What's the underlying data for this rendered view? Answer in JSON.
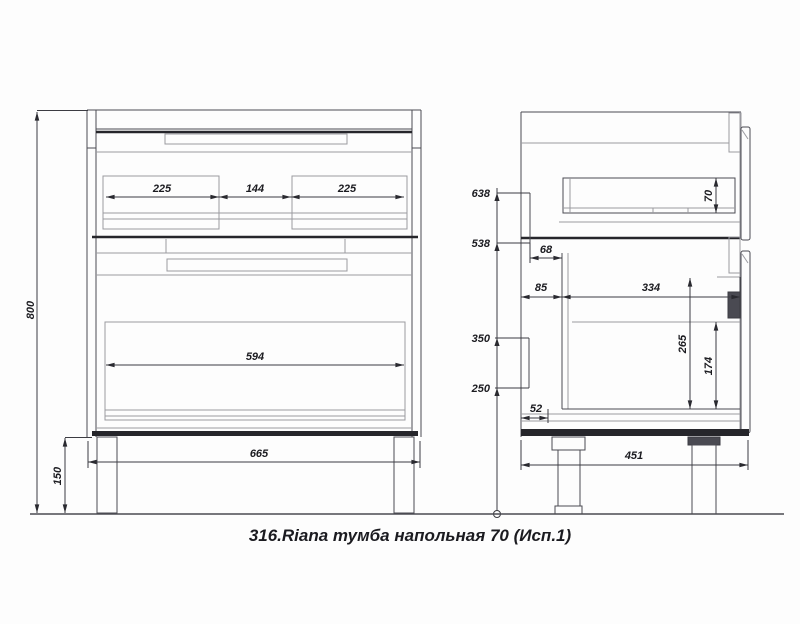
{
  "title": "316.Riana тумба напольная 70 (Исп.1)",
  "front_view": {
    "overall_height": "800",
    "leg_height": "150",
    "overall_width": "665",
    "drawer_inner_width": "594",
    "segment_left": "225",
    "segment_middle": "144",
    "segment_right": "225"
  },
  "side_view": {
    "back_bracket_top_height": "638",
    "back_bracket_bottom_height": "538",
    "lower_bracket_top_height": "350",
    "lower_bracket_bottom_height": "250",
    "depth": "451",
    "top_drawer_box_height": "70",
    "back_offset_top": "68",
    "back_offset_bottom": "85",
    "drawer_box_length": "334",
    "opening_height": "265",
    "drawer_side_height": "174",
    "bottom_back_offset": "52"
  }
}
